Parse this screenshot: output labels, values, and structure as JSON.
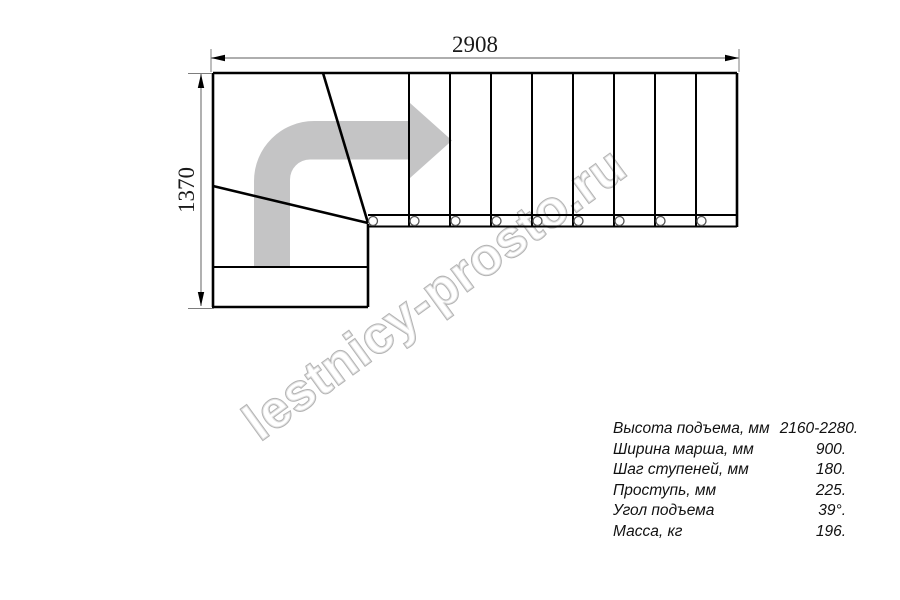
{
  "watermark": "lestnicy-prosto.ru",
  "dimensions": {
    "width_label": "2908",
    "height_label": "1370"
  },
  "drawing": {
    "arrow_color": "#c4c4c5",
    "line_color": "#000000",
    "dim_line_color": "#7d7d7d",
    "watermark_outline_color": "#b3b3b3",
    "tread_count_straight": 9,
    "baluster_count": 9
  },
  "specs": {
    "rows": [
      {
        "label": "Высота подъема, мм",
        "value": "2160-2280."
      },
      {
        "label": "Ширина марша, мм",
        "value": "900."
      },
      {
        "label": "Шаг ступеней, мм",
        "value": "180."
      },
      {
        "label": "Проступь, мм",
        "value": "225."
      },
      {
        "label": "Угол подъема",
        "value": "39°."
      },
      {
        "label": "Масса, кг",
        "value": "196."
      }
    ]
  }
}
